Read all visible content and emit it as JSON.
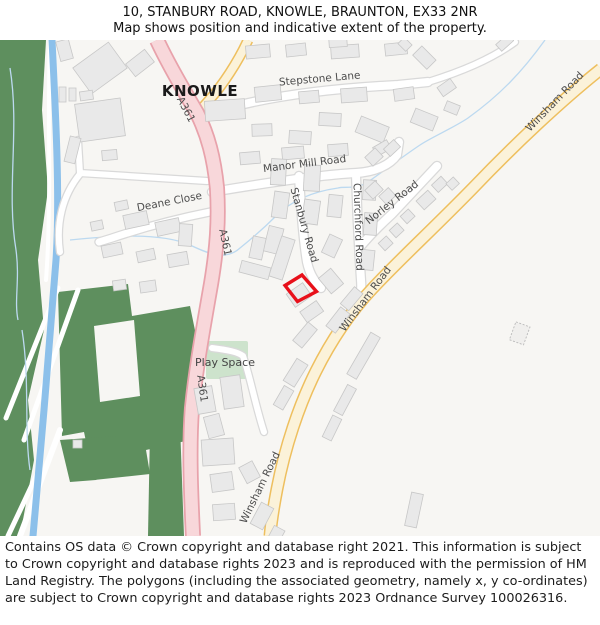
{
  "header": {
    "title": "10, STANBURY ROAD, KNOWLE, BRAUNTON, EX33 2NR",
    "subtitle": "Map shows position and indicative extent of the property."
  },
  "map": {
    "place_labels": {
      "town": "KNOWLE",
      "play_space": "Play Space"
    },
    "road_labels": {
      "stepstone_lane": "Stepstone Lane",
      "manor_mill_road": "Manor Mill Road",
      "deane_close": "Deane Close",
      "stanbury_road": "Stanbury Road",
      "churchford_road": "Churchford Road",
      "norley_road": "Norley Road",
      "winsham_road": "Winsham Road",
      "a361": "A361"
    },
    "marker_color": "#e8101a",
    "colors": {
      "land": "#f7f6f3",
      "building": "#e9e9e9",
      "woodland": "#5e8f5e",
      "greenspace": "#cde3cc",
      "water": "#8cc0ea",
      "a_road_fill": "#f8d7da",
      "a_road_casing": "#e8a2ab",
      "b_road_fill": "#fbf2d9",
      "b_road_casing": "#eebf5e",
      "minor_road_casing": "#d9d9d9"
    }
  },
  "footer": {
    "attribution": "Contains OS data © Crown copyright and database right 2021. This information is subject to Crown copyright and database rights 2023 and is reproduced with the permission of HM Land Registry. The polygons (including the associated geometry, namely x, y co-ordinates) are subject to Crown copyright and database rights 2023 Ordnance Survey 100026316."
  }
}
